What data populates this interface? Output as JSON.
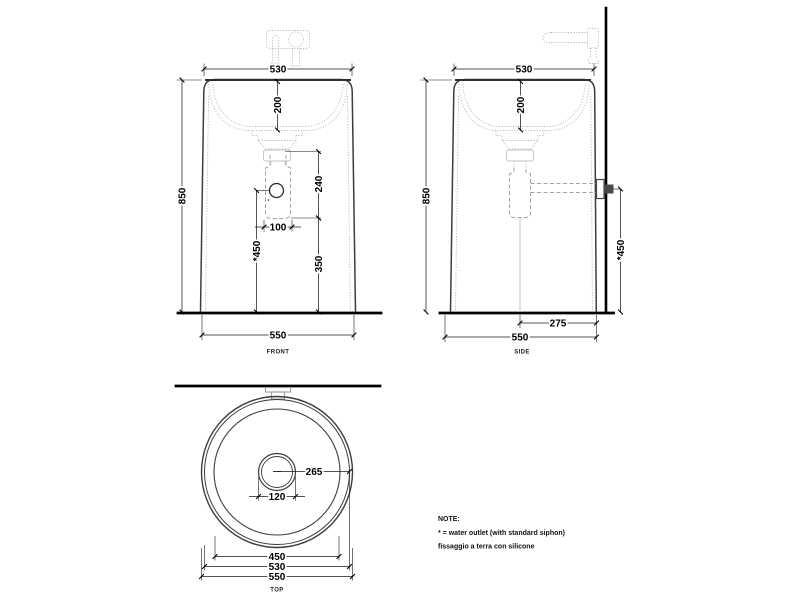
{
  "drawing": {
    "type": "technical-drawing-freestanding-washbasin",
    "ink_color": "#1a1a1a",
    "faint_color": "#b9b9b9",
    "background": "#ffffff"
  },
  "front": {
    "label": "FRONT",
    "dim_top_width": "530",
    "dim_bowl_depth": "200",
    "dim_height": "850",
    "dim_siphon_drop": "240",
    "dim_siphon_width": "100",
    "dim_outlet_floor": "350",
    "dim_outlet_height": "*450",
    "dim_base_width": "550"
  },
  "side": {
    "label": "SIDE",
    "dim_top_width": "530",
    "dim_bowl_depth": "200",
    "dim_height": "850",
    "dim_wall_offset": "275",
    "dim_outlet_height": "*450",
    "dim_base_width": "550"
  },
  "top": {
    "label": "TOP",
    "dim_center_to_edge": "265",
    "dim_drain": "120",
    "dim_inner_rim": "450",
    "dim_mid_diameter": "530",
    "dim_outer_diameter": "550"
  },
  "note": {
    "title": "NOTE:",
    "lines": [
      "* = water outlet (with standard siphon)",
      "fissaggio a terra con silicone"
    ]
  }
}
